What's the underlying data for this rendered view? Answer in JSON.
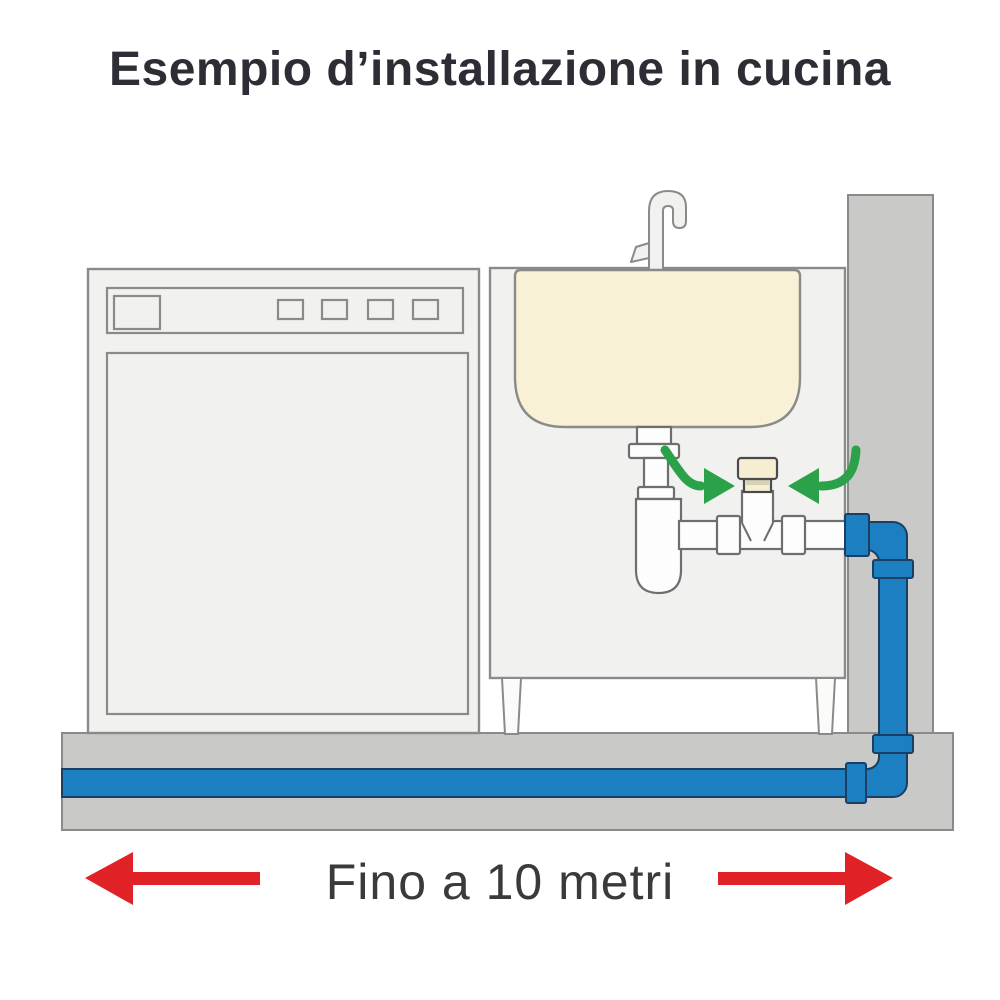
{
  "title": "Esempio d’installazione in cucina",
  "distance_label": "Fino a 10 metri",
  "colors": {
    "title-text": "#2d2d35",
    "label-text": "#3a3a3a",
    "wall-fill": "#c9c9c7",
    "appliance-fill": "#f1f1ef",
    "appliance-stroke": "#8a8a8a",
    "sink-fill": "#f8f1d6",
    "pipe-white-fill": "#fdfdfd",
    "pipe-white-stroke": "#6e6e6e",
    "pipe-blue-fill": "#1b7fc2",
    "pipe-blue-stroke": "#1b3f63",
    "valve-fill": "#f5eed2",
    "valve-band": "#d6d0b6",
    "valve-stroke": "#4a4a4a",
    "arrow-green": "#2ba24a",
    "arrow-red": "#e02125"
  }
}
